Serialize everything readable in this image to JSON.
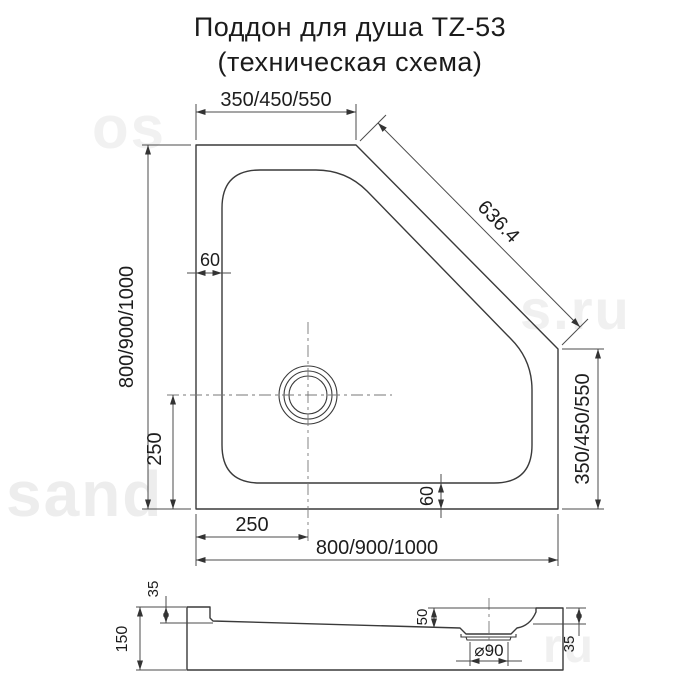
{
  "title": "Поддон для душа TZ-53",
  "subtitle": "(техническая схема)",
  "watermarks": {
    "bottom_left": "sand",
    "top_left": "os",
    "mid_right": "s.ru",
    "bottom_right": "ru"
  },
  "top_view": {
    "top_width": "350/450/550",
    "diagonal": "636.4",
    "left_height": "800/900/1000",
    "inset_left": "60",
    "inset_bottom": "60",
    "drain_offset_left": "250",
    "drain_offset_bottom": "250",
    "bottom_width": "800/900/1000",
    "right_height": "350/450/550"
  },
  "side_view": {
    "total_height": "150",
    "rim_height_left": "35",
    "basin_depth": "50",
    "drain_diameter": "⌀90",
    "rim_height_right": "35"
  }
}
